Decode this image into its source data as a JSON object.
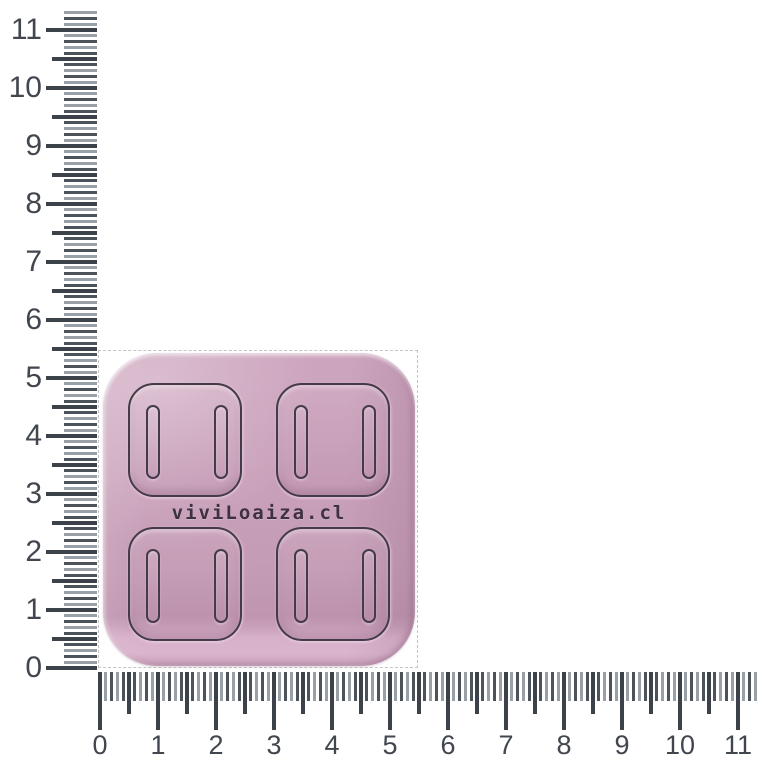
{
  "canvas": {
    "width": 760,
    "height": 760,
    "background": "#ffffff"
  },
  "rulers": {
    "unit_px": 58,
    "tick_step": 0.1,
    "colors": {
      "major": "#3c424a",
      "minor_dark": "#4d535b",
      "minor_light": "#9aa0a7",
      "label": "#42474f"
    },
    "vertical": {
      "labels": [
        "0",
        "1",
        "2",
        "3",
        "4",
        "5",
        "6",
        "7",
        "8",
        "9",
        "10",
        "11"
      ],
      "origin_y": 668,
      "max_value": 11.3,
      "strip_right": 97,
      "len_minor": 33,
      "len_half": 45,
      "len_major": 51
    },
    "horizontal": {
      "labels": [
        "0",
        "1",
        "2",
        "3",
        "4",
        "5",
        "6",
        "7",
        "8",
        "9",
        "10",
        "11"
      ],
      "origin_x": 100,
      "max_value": 11.3,
      "strip_top": 672,
      "len_minor": 29,
      "len_half": 42,
      "len_major": 58
    }
  },
  "selection": {
    "left": 98,
    "top": 350,
    "width": 320,
    "height": 318,
    "border_color": "#c4c4c4"
  },
  "product": {
    "kind": "silicone-mold",
    "brand_text": "viviLoaiza.cl",
    "left": 103,
    "top": 353,
    "width": 312,
    "height": 313,
    "corner_radius": 54,
    "brand_text_top": 149,
    "colors": {
      "base": "#c79fb8",
      "light": "#d2a9c2",
      "dark": "#b78da8",
      "edge_highlight": "#e3c4d8",
      "outline": "#453b48",
      "text": "#3e3140"
    },
    "grid": {
      "rows": 2,
      "cols": 2,
      "cell": {
        "width": 114,
        "height": 114,
        "radius": 26,
        "margin_x": 25,
        "top_row_y": 30,
        "bottom_row_y": 174,
        "gap_x": 34
      },
      "slot": {
        "width": 14,
        "height": 74,
        "radius": 9,
        "inset_x": 16
      }
    }
  }
}
